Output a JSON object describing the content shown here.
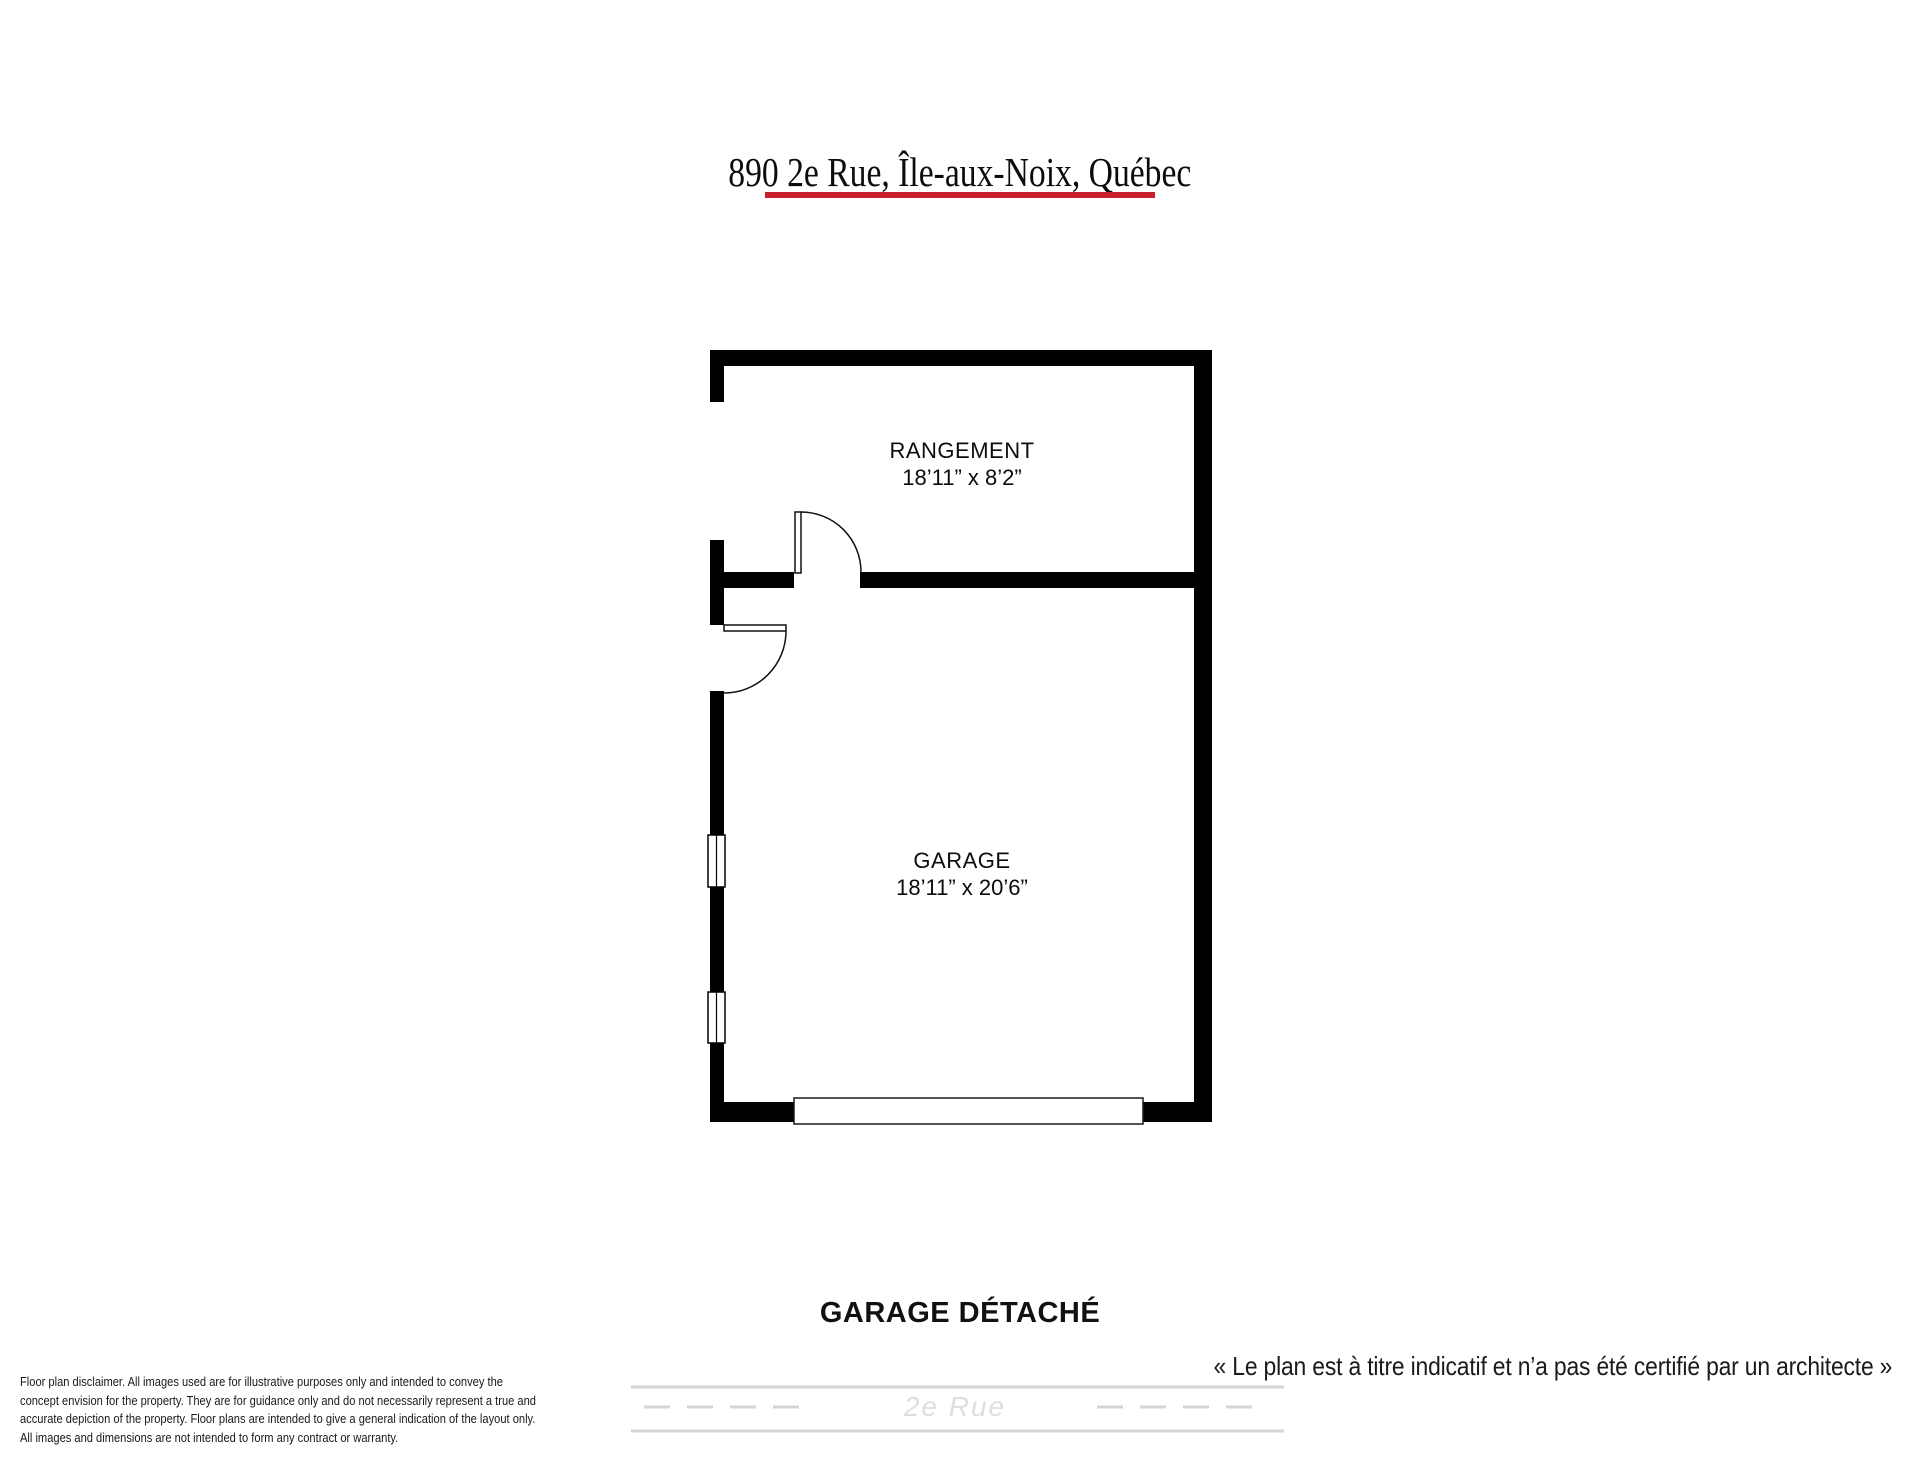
{
  "header": {
    "title": "890 2e Rue, Île-aux-Noix, Québec",
    "underline_color": "#c8202c"
  },
  "floor_plan": {
    "rooms": [
      {
        "name": "RANGEMENT",
        "dimensions": "18’11” x 8’2”"
      },
      {
        "name": "GARAGE",
        "dimensions": "18’11” x 20’6”"
      }
    ],
    "features": [
      "interior-door",
      "exterior-door",
      "window",
      "window",
      "garage-door"
    ]
  },
  "caption": "GARAGE DÉTACHÉ",
  "note": "« Le plan est à titre indicatif et n’a pas été certifié par un architecte »",
  "street": {
    "label": "2e Rue"
  },
  "disclaimer": {
    "lines": [
      "Floor plan disclaimer. All images used are for illustrative purposes only and intended to convey the",
      "concept envision for the property. They are for guidance only and do not necessarily represent a true and",
      "accurate depiction of the property. Floor plans are intended to give a general indication of the layout only.",
      "All images and dimensions are not intended to form any contract or warranty."
    ]
  },
  "colors": {
    "wall": "#000000",
    "accent_red": "#c8202c",
    "road_gray": "#d5d5d5",
    "street_text_gray": "#dedede"
  }
}
